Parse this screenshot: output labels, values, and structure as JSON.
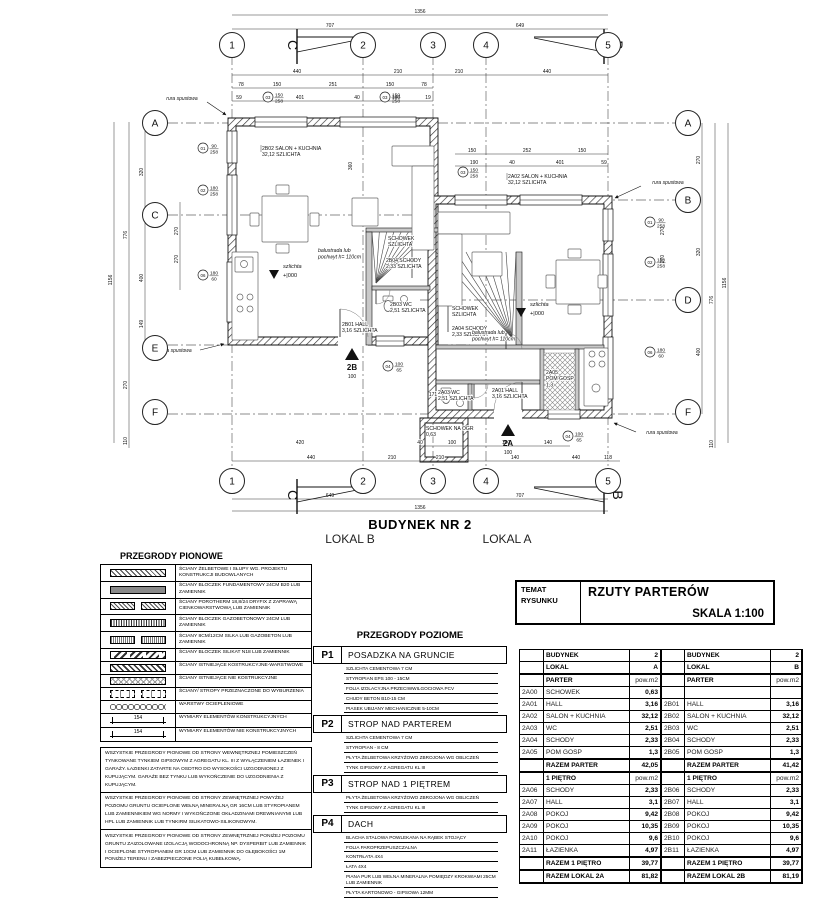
{
  "plan": {
    "building_title": "BUDYNEK NR 2",
    "lokal_b": "LOKAL B",
    "lokal_a": "LOKAL A",
    "grid": {
      "cols": [
        {
          "id": "1",
          "x": 232
        },
        {
          "id": "2",
          "x": 363
        },
        {
          "id": "3",
          "x": 433
        },
        {
          "id": "4",
          "x": 486
        },
        {
          "id": "5",
          "x": 608
        }
      ],
      "rows": [
        {
          "id": "A",
          "y": 123,
          "x0": 168,
          "x1": 675,
          "left": true,
          "right": true
        },
        {
          "id": "B",
          "y": 200,
          "x0": 420,
          "x1": 675,
          "left": false,
          "right": true
        },
        {
          "id": "C",
          "y": 215,
          "x0": 168,
          "x1": 470,
          "left": true,
          "right": false
        },
        {
          "id": "D",
          "y": 300,
          "x0": 420,
          "x1": 675,
          "left": false,
          "right": true
        },
        {
          "id": "E",
          "y": 345,
          "x0": 168,
          "x1": 470,
          "left": true,
          "right": false
        },
        {
          "id": "F",
          "y": 414,
          "x0": 168,
          "x1": 675,
          "left": true,
          "right": true
        }
      ],
      "bubble_top_y": 45,
      "bubble_bottom_y": 481,
      "bubble_left_x": 155,
      "bubble_right_x": 688
    },
    "dims_h": [
      {
        "t": "1356",
        "x": 420,
        "y": 13
      },
      {
        "t": "707",
        "x": 330,
        "y": 27
      },
      {
        "t": "649",
        "x": 520,
        "y": 27
      },
      {
        "t": "440",
        "x": 297,
        "y": 73
      },
      {
        "t": "210",
        "x": 398,
        "y": 73
      },
      {
        "t": "210",
        "x": 459,
        "y": 73
      },
      {
        "t": "440",
        "x": 547,
        "y": 73
      },
      {
        "t": "78",
        "x": 241,
        "y": 86
      },
      {
        "t": "150",
        "x": 277,
        "y": 86
      },
      {
        "t": "251",
        "x": 333,
        "y": 86
      },
      {
        "t": "150",
        "x": 390,
        "y": 86
      },
      {
        "t": "78",
        "x": 424,
        "y": 86
      },
      {
        "t": "59",
        "x": 239,
        "y": 99
      },
      {
        "t": "401",
        "x": 300,
        "y": 99
      },
      {
        "t": "40",
        "x": 357,
        "y": 99
      },
      {
        "t": "190",
        "x": 396,
        "y": 99
      },
      {
        "t": "19",
        "x": 428,
        "y": 99
      },
      {
        "t": "150",
        "x": 472,
        "y": 152
      },
      {
        "t": "252",
        "x": 527,
        "y": 152
      },
      {
        "t": "150",
        "x": 582,
        "y": 152
      },
      {
        "t": "190",
        "x": 474,
        "y": 164
      },
      {
        "t": "40",
        "x": 512,
        "y": 164
      },
      {
        "t": "401",
        "x": 560,
        "y": 164
      },
      {
        "t": "59",
        "x": 604,
        "y": 164
      },
      {
        "t": "243",
        "x": 565,
        "y": 380
      },
      {
        "t": "171",
        "x": 433,
        "y": 396
      },
      {
        "t": "420",
        "x": 300,
        "y": 444
      },
      {
        "t": "40",
        "x": 420,
        "y": 444
      },
      {
        "t": "100",
        "x": 452,
        "y": 444
      },
      {
        "t": "100",
        "x": 506,
        "y": 444
      },
      {
        "t": "140",
        "x": 548,
        "y": 444
      },
      {
        "t": "440",
        "x": 311,
        "y": 459
      },
      {
        "t": "210",
        "x": 392,
        "y": 459
      },
      {
        "t": "210",
        "x": 440,
        "y": 459
      },
      {
        "t": "140",
        "x": 515,
        "y": 459
      },
      {
        "t": "440",
        "x": 576,
        "y": 459
      },
      {
        "t": "118",
        "x": 608,
        "y": 459
      },
      {
        "t": "649",
        "x": 330,
        "y": 497
      },
      {
        "t": "707",
        "x": 520,
        "y": 497
      },
      {
        "t": "1356",
        "x": 420,
        "y": 509
      }
    ],
    "dims_v": [
      {
        "t": "1156",
        "x": 112,
        "y": 280
      },
      {
        "t": "776",
        "x": 127,
        "y": 235
      },
      {
        "t": "270",
        "x": 127,
        "y": 385
      },
      {
        "t": "110",
        "x": 127,
        "y": 441
      },
      {
        "t": "320",
        "x": 143,
        "y": 172
      },
      {
        "t": "400",
        "x": 143,
        "y": 278
      },
      {
        "t": "149",
        "x": 143,
        "y": 324
      },
      {
        "t": "270",
        "x": 178,
        "y": 231
      },
      {
        "t": "270",
        "x": 178,
        "y": 259
      },
      {
        "t": "360",
        "x": 352,
        "y": 166
      },
      {
        "t": "270",
        "x": 700,
        "y": 160
      },
      {
        "t": "320",
        "x": 700,
        "y": 252
      },
      {
        "t": "400",
        "x": 700,
        "y": 352
      },
      {
        "t": "270",
        "x": 664,
        "y": 231
      },
      {
        "t": "270",
        "x": 664,
        "y": 259
      },
      {
        "t": "776",
        "x": 713,
        "y": 300
      },
      {
        "t": "110",
        "x": 713,
        "y": 444
      },
      {
        "t": "1156",
        "x": 726,
        "y": 283
      }
    ],
    "dim_hlines": [
      {
        "y": 15,
        "x0": 232,
        "x1": 608
      },
      {
        "y": 29,
        "x0": 232,
        "x1": 608
      },
      {
        "y": 75,
        "x0": 232,
        "x1": 608
      },
      {
        "y": 88,
        "x0": 232,
        "x1": 433
      },
      {
        "y": 101,
        "x0": 232,
        "x1": 433
      },
      {
        "y": 154,
        "x0": 455,
        "x1": 608
      },
      {
        "y": 166,
        "x0": 455,
        "x1": 608
      },
      {
        "y": 446,
        "x0": 420,
        "x1": 570
      },
      {
        "y": 461,
        "x0": 232,
        "x1": 620
      },
      {
        "y": 499,
        "x0": 232,
        "x1": 608
      },
      {
        "y": 511,
        "x0": 232,
        "x1": 608
      }
    ],
    "dim_vlines": [
      {
        "x": 114,
        "y0": 122,
        "y1": 443
      },
      {
        "x": 129,
        "y0": 122,
        "y1": 448
      },
      {
        "x": 145,
        "y0": 122,
        "y1": 345
      },
      {
        "x": 180,
        "y0": 202,
        "y1": 290
      },
      {
        "x": 702,
        "y0": 123,
        "y1": 414
      },
      {
        "x": 715,
        "y0": 123,
        "y1": 448
      },
      {
        "x": 728,
        "y0": 123,
        "y1": 443
      }
    ],
    "rooms": [
      {
        "x": 262,
        "y": 150,
        "lines": [
          "2B02   SALON + KUCHNIA",
          "32,12   SZLICHTA"
        ]
      },
      {
        "x": 388,
        "y": 240,
        "lines": [
          "SCHOWEK",
          "SZLICHTA"
        ]
      },
      {
        "x": 386,
        "y": 262,
        "lines": [
          "2B04  SCHODY",
          "2,33  SZLICHTA"
        ]
      },
      {
        "x": 390,
        "y": 306,
        "lines": [
          "2B03  WC",
          "2,51  SZLICHTA"
        ]
      },
      {
        "x": 342,
        "y": 326,
        "lines": [
          "2B01  HALL",
          "3,16  SZLICHTA"
        ]
      },
      {
        "x": 508,
        "y": 178,
        "lines": [
          "2A02   SALON + KUCHNIA",
          "32,12   SZLICHTA"
        ]
      },
      {
        "x": 452,
        "y": 310,
        "lines": [
          "SCHOWEK",
          "SZLICHTA"
        ]
      },
      {
        "x": 452,
        "y": 330,
        "lines": [
          "2A04  SCHODY",
          "2,33  SZLICHTA"
        ]
      },
      {
        "x": 438,
        "y": 394,
        "lines": [
          "2A03  WC",
          "2,51  SZLICHTA"
        ]
      },
      {
        "x": 492,
        "y": 392,
        "lines": [
          "2A01  HALL",
          "3,16  SZLICHTA"
        ]
      },
      {
        "x": 546,
        "y": 374,
        "lines": [
          "2A05",
          "POM GOSP",
          "1,3"
        ]
      },
      {
        "x": 426,
        "y": 430,
        "lines": [
          "SCHOWEK NA OGR",
          "0,63"
        ]
      }
    ],
    "window_markers": [
      {
        "no": "03",
        "x": 268,
        "y": 97,
        "d1": "150",
        "d2": "258"
      },
      {
        "no": "03",
        "x": 385,
        "y": 97,
        "d1": "150",
        "d2": "258"
      },
      {
        "no": "01",
        "x": 203,
        "y": 148,
        "d1": "90",
        "d2": "258"
      },
      {
        "no": "02",
        "x": 203,
        "y": 190,
        "d1": "180",
        "d2": "258"
      },
      {
        "no": "06",
        "x": 203,
        "y": 275,
        "d1": "180",
        "d2": "60"
      },
      {
        "no": "03",
        "x": 463,
        "y": 172,
        "d1": "150",
        "d2": "258"
      },
      {
        "no": "01",
        "x": 650,
        "y": 222,
        "d1": "90",
        "d2": "258"
      },
      {
        "no": "02",
        "x": 650,
        "y": 262,
        "d1": "180",
        "d2": "258"
      },
      {
        "no": "06",
        "x": 650,
        "y": 352,
        "d1": "180",
        "d2": "60"
      },
      {
        "no": "04",
        "x": 388,
        "y": 366,
        "d1": "100",
        "d2": "65"
      },
      {
        "no": "04",
        "x": 568,
        "y": 436,
        "d1": "100",
        "d2": "65"
      }
    ],
    "downspout_text": "rura spustowa",
    "downspouts": [
      {
        "x": 182,
        "y": 100,
        "ax0": 207,
        "ay0": 102,
        "ax1": 226,
        "ay1": 115
      },
      {
        "x": 176,
        "y": 352,
        "ax0": 200,
        "ay0": 350,
        "ax1": 224,
        "ay1": 344
      },
      {
        "x": 668,
        "y": 184,
        "ax0": 641,
        "ay0": 186,
        "ax1": 615,
        "ay1": 198
      },
      {
        "x": 662,
        "y": 434,
        "ax0": 636,
        "ay0": 432,
        "ax1": 614,
        "ay1": 423
      }
    ],
    "balustrade_lines": [
      "balustrada lub",
      "pochwyt h= 110cm"
    ],
    "balustrades": [
      {
        "x": 318,
        "y": 252
      },
      {
        "x": 472,
        "y": 334
      }
    ],
    "level_text": "szlichta",
    "level_value": "+|000",
    "levels": [
      {
        "x": 283,
        "y": 268
      },
      {
        "x": 530,
        "y": 306
      }
    ],
    "entrance_dim": "100",
    "entrances": [
      {
        "label": "2B",
        "x": 352,
        "y": 352
      },
      {
        "label": "2A",
        "x": 508,
        "y": 428
      }
    ],
    "section_marks": [
      {
        "label": "C",
        "x": 297,
        "y": 38,
        "side": "left",
        "vpos": "top"
      },
      {
        "label": "B",
        "x": 604,
        "y": 38,
        "side": "right",
        "vpos": "top"
      },
      {
        "label": "C",
        "x": 297,
        "y": 487,
        "side": "left",
        "vpos": "bottom"
      },
      {
        "label": "B",
        "x": 604,
        "y": 487,
        "side": "right",
        "vpos": "bottom"
      }
    ]
  },
  "legend_vertical": {
    "title": "PRZEGRODY PIONOWE",
    "items": [
      {
        "pattern": "pat-diag",
        "double": false,
        "text": "ŚCIANY ŻELBETOWE I SŁUPY WG. PROJEKTU KONSTRUKCJI BUDOWLANYCH"
      },
      {
        "pattern": "pat-solid",
        "double": false,
        "text": "ŚCIANY BLOCZEK FUNDAMENTOWY 24CM B20 LUB ZAMIENNIK"
      },
      {
        "pattern": "pat-diamond",
        "double": true,
        "text": "ŚCIANY POROTHERM 18,8/24 DRYFIX Z ZAPRAWĄ CIENKOWARSTWOWĄ LUB ZAMIENNIK"
      },
      {
        "pattern": "pat-vlines",
        "double": false,
        "text": "ŚCIANY BLOCZEK GAZOBETONOWY 24CM LUB ZAMIENNIK"
      },
      {
        "pattern": "pat-fine",
        "double": true,
        "text": "ŚCIANY 8CM/12CM SILKA LUB GAZOBETON LUB ZAMIENNIK"
      },
      {
        "pattern": "pat-silikat",
        "double": false,
        "text": "ŚCIANY BLOCZEK SILIKAT N18 LUB ZAMIENNIK"
      },
      {
        "pattern": "pat-exist",
        "double": false,
        "text": "ŚCIANY ISTNIEJĄCE KOSTRUKCYJNE-WARSTWOWE"
      },
      {
        "pattern": "pat-cross",
        "double": false,
        "text": "ŚCIANY ISTNIEJĄCE NIE KOSTRUKCYJNE"
      },
      {
        "pattern": "pat-demol",
        "double": true,
        "text": "ŚCIANY/ STROPY  PRZEZNACZONE DO WYBURZENIA"
      },
      {
        "pattern": "pat-insul",
        "double": false,
        "text": "WARSTWY OCIEPLENIOWE"
      },
      {
        "pattern": "dim-k",
        "double": false,
        "text": "WYMIARY ELEMENTÓW KONSTRUKCYJNYCH"
      },
      {
        "pattern": "dim-n",
        "double": false,
        "text": "WYMIARY ELEMENTÓW NIE KONSTRUKCYJNYCH"
      }
    ],
    "dim_example": "154",
    "notes": [
      "WSZYSTKIE PRZEGRODY PIONOWE OD STRONY WEWNĘTRZNEJ POMIESZCZEŃ TYNKOWANE TYNKIEM GIPSOWYM Z AGREGATU KL. III Z WYŁĄCZENIEM ŁAZIENEK I GARAŻY. ŁAZIENKI ZATARTE NA OSDTRO DO WYSOKOŚCI UZGODNIONEJ Z KUPUJĄCYM. GARAŻE BEZ TYNKU LUB WYKOŃCZENIE DO UZGODNIENIA Z KUPUJĄCYM.",
      "WSZYSTKIE PRZEGRODY PIONOWE OD STRONY ZEWNĘTRZNEJ POWYŻEJ POZIOMU GRUNTU OCIEPLONE WEŁNĄ MINERALNĄ GR 16CM LUB STYROPIANEM LUB ZAMIENNIKIEM WG NORMY I WYKOŃCZONE OKŁADZINAMI DREWNIANYMI LUB HPL LUB ZAMIENNIK LUB TYNKIRM SILIKATOWO-SILIKONOWYM.",
      "WSZYSTKIE PRZEGRODY PIONOWE OD STRONY ZEWNĘTRZNEJ PONIŻEJ POZIOMU GRUNTU ZAIZOLOWANE IZOLACJĄ WODOCHRONNĄ NP. DYSPERBIT LUB ZAMIENNIK I OCIEPLONE STYROPIANEM GR 10CM LUB ZAMIENNIK DO GŁĘBOKOŚCI 1M PONIŻEJ TERENU I ZABEZPIECZONE FOLIĄ KUBEŁKOWĄ."
    ]
  },
  "legend_horizontal": {
    "title": "PRZEGRODY POZIOME",
    "items": [
      {
        "code": "P1",
        "name": "POSADZKA NA GRUNCIE",
        "layers": [
          "SZLICHTA CEMENTOWA  7 CM",
          "STYROPIAN EPS 100 - 15CM",
          "FOLIA IZOLACYJNA PRZECIWWILGOCIOWA  PCV",
          "CHUDY BETON B10-15 CM",
          "PIASEK UBIJANY MECHANICZNIE 5-10CM"
        ]
      },
      {
        "code": "P2",
        "name": "STROP NAD PARTEREM",
        "layers": [
          "SZLICHTA CEMENTOWA  7 CM",
          "STYROPIAN - 8 CM",
          "PŁYTA ŻELBETOWA KRZYŻOWO ZBROJONA WG OBLICZEŃ",
          "TYNK GIPSOWY Z AGREGATU KL III"
        ]
      },
      {
        "code": "P3",
        "name": "STROP NAD 1 PIĘTREM",
        "layers": [
          "PŁYTA ŻELBETOWA KRZYŻOWO ZBROJONA WG OBLICZEŃ",
          "TYNK GIPSOWY Z AGREGATU KL III"
        ]
      },
      {
        "code": "P4",
        "name": "DACH",
        "layers": [
          "BLACHA STALOWA POWLEKANA NA RĄBEK STOJĄCY",
          "FOLIA PAROPRZEPUSZCZALNA",
          "KONTRŁATA 4X4",
          "ŁATA 4X4",
          "PIANA PUR LUB WEŁNA MINERALNA  POMIĘDZY KROKWIAMI 25CM LUB ZAMIENNIK",
          "PŁYTA KARTONOWO - GIPSOWA 12MM"
        ]
      }
    ]
  },
  "title_block": {
    "label_line1": "TEMAT",
    "label_line2": "RYSUNKU",
    "title": "RZUTY PARTERÓW",
    "scale": "SKALA 1:100"
  },
  "area_table": {
    "halves": [
      {
        "budynek_label": "BUDYNEK",
        "budynek": "2",
        "lokal_label": "LOKAL",
        "lokal": "A",
        "parter_label": "PARTER",
        "unit": "pow.m2",
        "parter": [
          [
            "2A00",
            "SCHOWEK",
            "0,63"
          ],
          [
            "2A01",
            "HALL",
            "3,16"
          ],
          [
            "2A02",
            "SALON + KUCHNIA",
            "32,12"
          ],
          [
            "2A03",
            "WC",
            "2,51"
          ],
          [
            "2A04",
            "SCHODY",
            "2,33"
          ],
          [
            "2A05",
            "POM GOSP",
            "1,3"
          ]
        ],
        "razem_parter": [
          "RAZEM PARTER",
          "42,05"
        ],
        "pietro_label": "1 PIĘTRO",
        "pietro": [
          [
            "2A06",
            "SCHODY",
            "2,33"
          ],
          [
            "2A07",
            "HALL",
            "3,1"
          ],
          [
            "2A08",
            "POKOJ",
            "9,42"
          ],
          [
            "2A09",
            "POKOJ",
            "10,35"
          ],
          [
            "2A10",
            "POKOJ",
            "9,6"
          ],
          [
            "2A11",
            "ŁAZIENKA",
            "4,97"
          ]
        ],
        "razem_pietro": [
          "RAZEM 1 PIĘTRO",
          "39,77"
        ],
        "razem_lokal": [
          "RAZEM LOKAL 2A",
          "81,82"
        ]
      },
      {
        "budynek_label": "BUDYNEK",
        "budynek": "2",
        "lokal_label": "LOKAL",
        "lokal": "B",
        "parter_label": "PARTER",
        "unit": "pow.m2",
        "parter": [
          [
            "",
            "",
            ""
          ],
          [
            "2B01",
            "HALL",
            "3,16"
          ],
          [
            "2B02",
            "SALON + KUCHNIA",
            "32,12"
          ],
          [
            "2B03",
            "WC",
            "2,51"
          ],
          [
            "2B04",
            "SCHODY",
            "2,33"
          ],
          [
            "2B05",
            "POM GOSP",
            "1,3"
          ]
        ],
        "razem_parter": [
          "RAZEM PARTER",
          "41,42"
        ],
        "pietro_label": "1 PIĘTRO",
        "pietro": [
          [
            "2B06",
            "SCHODY",
            "2,33"
          ],
          [
            "2B07",
            "HALL",
            "3,1"
          ],
          [
            "2B08",
            "POKOJ",
            "9,42"
          ],
          [
            "2B09",
            "POKOJ",
            "10,35"
          ],
          [
            "2B10",
            "POKOJ",
            "9,6"
          ],
          [
            "2B11",
            "ŁAZIENKA",
            "4,97"
          ]
        ],
        "razem_pietro": [
          "RAZEM 1 PIĘTRO",
          "39,77"
        ],
        "razem_lokal": [
          "RAZEM LOKAL 2B",
          "81,19"
        ]
      }
    ]
  }
}
